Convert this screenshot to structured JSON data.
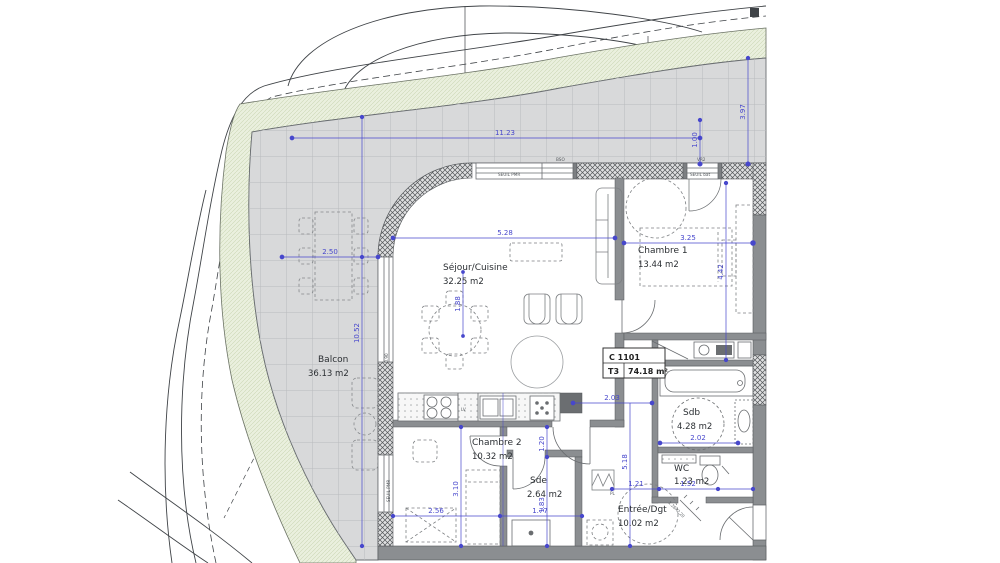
{
  "plan": {
    "unit": {
      "code": "C 1101",
      "type": "T3",
      "area": "74.18 m²"
    },
    "rooms": {
      "balcon": {
        "name": "Balcon",
        "area": "36.13 m2"
      },
      "sejour": {
        "name": "Séjour/Cuisine",
        "area": "32.25 m2"
      },
      "chambre1": {
        "name": "Chambre 1",
        "area": "13.44 m2"
      },
      "chambre2": {
        "name": "Chambre 2",
        "area": "10.32 m2"
      },
      "sde": {
        "name": "Sde",
        "area": "2.64 m2"
      },
      "sdb": {
        "name": "Sdb",
        "area": "4.28 m2"
      },
      "wc": {
        "name": "WC",
        "area": "1.23 m2"
      },
      "entree": {
        "name": "Entrée/Dgt",
        "area": "10.02 m2"
      }
    },
    "dims": {
      "w_top": "11.23",
      "w_balcony_gap": "1.00",
      "h_terrace": "3.97",
      "w_sejour": "5.28",
      "w_chambre1": "3.25",
      "w_balcon": "2.50",
      "h_balcon": "10.52",
      "h_chambre1": "4.42",
      "h_table": "1.88",
      "w_hall": "2.03",
      "h_hall": "5.18",
      "w_sdb": "2.02",
      "w_wc_left": "1.21",
      "w_wc": "1.52",
      "h_chambre2": "3.10",
      "w_chambre2": "2.56",
      "w_sde": "1.77",
      "h_sde_door": "1.20",
      "h_sde": "1.83",
      "sill": "0.90"
    },
    "annotations": {
      "bso": "BSO",
      "vr2": "VR2",
      "seuil_pmr": "SEUIL PMR",
      "seuil_bat": "SEUIL bat",
      "lv": "LV",
      "pl": "PL",
      "door_size": "1.26x2.20"
    },
    "colors": {
      "dimension_blue": "#4747cc",
      "wall_gray": "#8b8e91",
      "tile_gray": "#d8d9da",
      "landscape_green": "#eaf0de"
    }
  }
}
